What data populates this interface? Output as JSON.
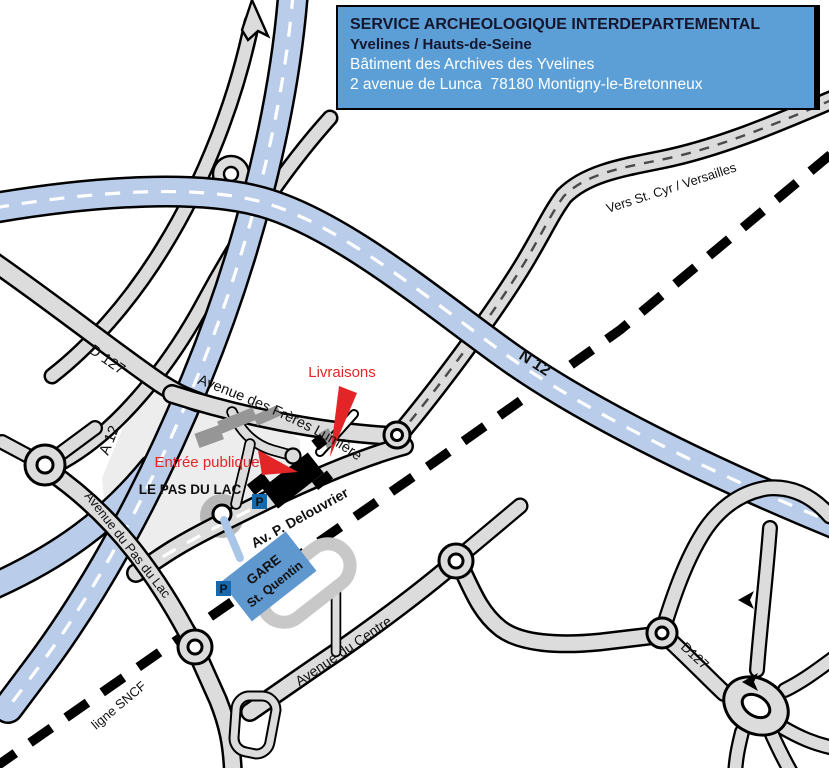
{
  "title_box": {
    "line1": "SERVICE ARCHEOLOGIQUE INTERDEPARTEMENTAL",
    "line2": "Yvelines / Hauts-de-Seine",
    "line3": "Bâtiment des Archives des Yvelines",
    "line4": "2 avenue de Lunca  78180 Montigny-le-Bretonneux",
    "bg_color": "#5b9fd6"
  },
  "map": {
    "road_labels": {
      "a12": "A 12",
      "n12": "N 12",
      "d127_west": "D 127",
      "d127_southeast": "D127",
      "freres_lumiere": "Avenue des Frères Lumière",
      "vers_st_cyr": "Vers St. Cyr / Versailles",
      "delouvrier": "Av. P. Delouvrier",
      "pas_du_lac_avenue": "Avenue du Pas du Lac",
      "centre": "Avenue du Centre",
      "sncf": "ligne SNCF"
    },
    "place_labels": {
      "district": "LE PAS DU LAC",
      "station_line1": "GARE",
      "station_line2": "St. Quentin",
      "parking": "P"
    },
    "poi_labels": {
      "deliveries": "Livraisons",
      "public_entrance": "Entrée publique"
    },
    "colors": {
      "motorway_fill": "#b9cce9",
      "road_fill": "#dcdcdc",
      "district_fill": "#ededed",
      "railway": "#000000",
      "station_fill": "#5f97cf",
      "parking_badge": "#1668ac",
      "accent_red": "#e42528",
      "building_black": "#000000",
      "building_gray": "#969696",
      "title_text_dark": "#16162e",
      "title_text_light": "#ffffff"
    }
  }
}
